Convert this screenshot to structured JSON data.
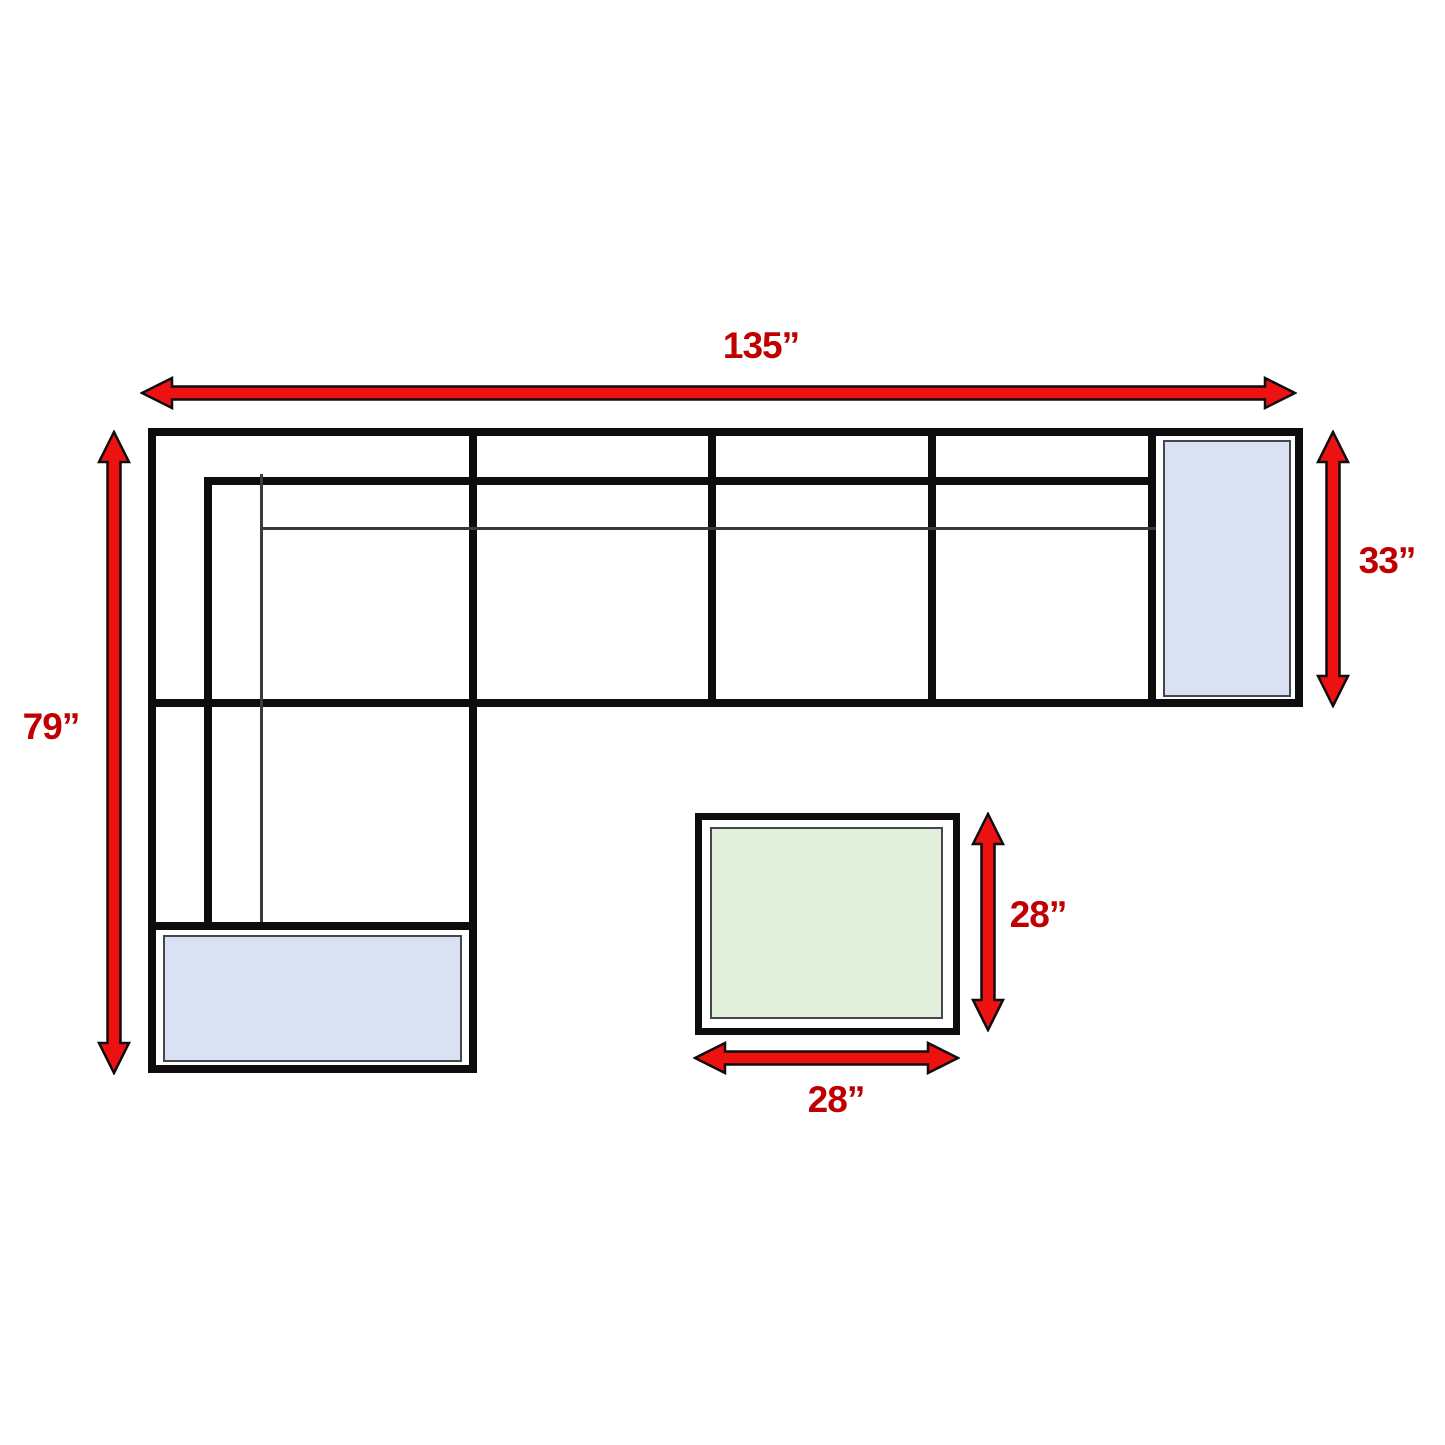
{
  "diagram": {
    "name": "Sectional sofa with ottoman — dimension diagram",
    "labels": {
      "overall_width": "135”",
      "overall_depth": "79”",
      "right_section_depth": "33”",
      "ottoman_depth": "28”",
      "ottoman_width": "28”"
    },
    "colors": {
      "arrow_fill": "#ed1111",
      "arrow_outline": "#0d0d0d",
      "label_text": "#c00000",
      "sofa_outline": "#0d0d0d",
      "cushion_blue": "#d9e1f2",
      "cushion_green": "#e2efda",
      "background": "#ffffff"
    }
  }
}
